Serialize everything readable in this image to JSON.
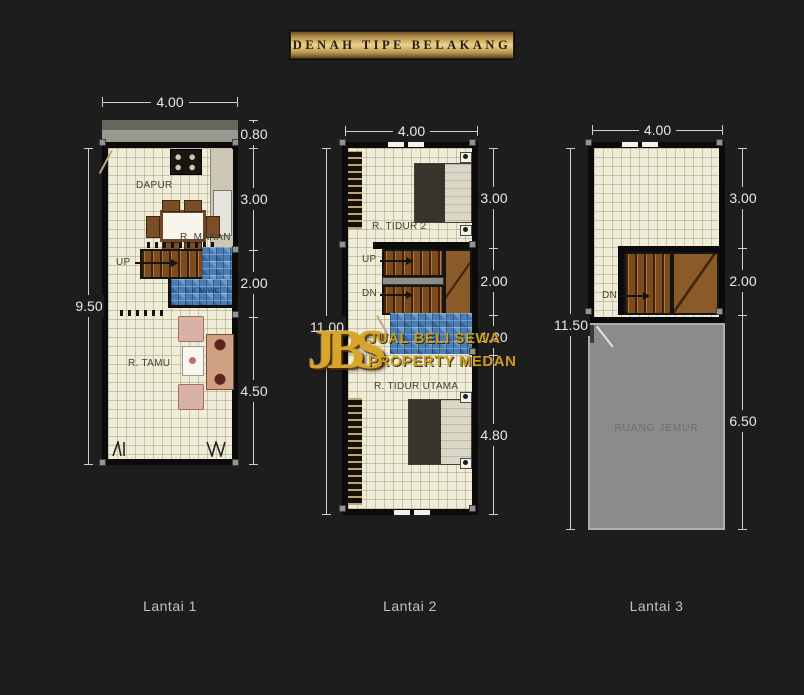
{
  "banner": {
    "title": "DENAH TIPE BELAKANG"
  },
  "watermark": {
    "logo": "JBS",
    "tagline_top": "JUAL BELI SEWA",
    "tagline_bottom": "PROPERTY MEDAN"
  },
  "floors": [
    {
      "label": "Lantai 1",
      "dims": {
        "top": "4.00",
        "left": "9.50",
        "right": [
          "0.80",
          "3.00",
          "2.00",
          "4.50"
        ]
      },
      "rooms": {
        "dapur": "DAPUR",
        "makan": "R. MAKAN",
        "up": "UP",
        "kmwc": "K.M/WC",
        "tamu": "R. TAMU"
      }
    },
    {
      "label": "Lantai 2",
      "dims": {
        "top": "4.00",
        "left": "11.00",
        "right": [
          "3.00",
          "2.00",
          "1.20",
          "4.80"
        ]
      },
      "rooms": {
        "tidur2": "R. TIDUR 2",
        "up": "UP",
        "dn": "DN",
        "tidur_utama": "R. TIDUR UTAMA"
      }
    },
    {
      "label": "Lantai 3",
      "dims": {
        "top": "4.00",
        "left": "11.50",
        "right": [
          "3.00",
          "2.00",
          "6.50"
        ]
      },
      "rooms": {
        "dn": "DN",
        "jemur": "RUANG JEMUR"
      }
    }
  ],
  "colors": {
    "background": "#1d1d1d",
    "banner_gold": "#e3c17a",
    "wall": "#0b0b0b",
    "floor_tile": "#efecda",
    "bath_blue": "#4a7db2",
    "stair_wood": "#7c4c1e",
    "service_gray": "#8b8b8b",
    "dim_text": "#e8e8e8",
    "watermark_gold": "#d7a42c"
  }
}
